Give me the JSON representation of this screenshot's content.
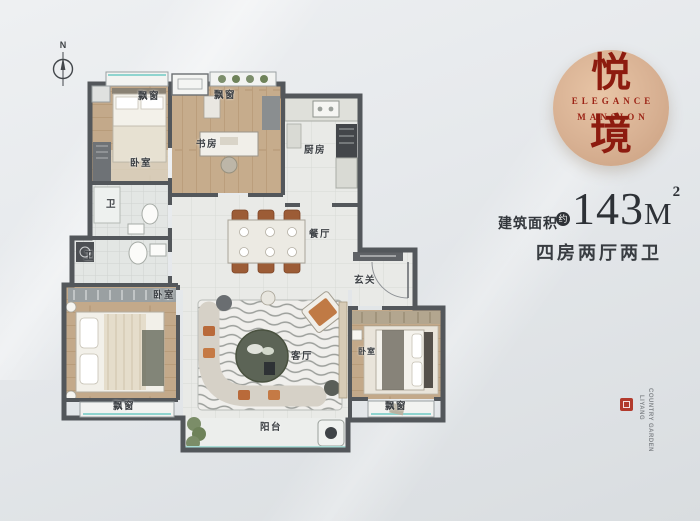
{
  "compass": {
    "label": "N"
  },
  "logo": {
    "char_top": "悦",
    "english_line1": "ELEGANCE",
    "english_line2": "MANSION",
    "char_bottom": "境"
  },
  "area": {
    "label": "建筑面积",
    "approx_badge": "约",
    "value": "143",
    "unit": "M",
    "superscript": "2"
  },
  "layout_summary": "四房两厅两卫",
  "floorplan": {
    "rooms": {
      "bedroom_top_left": "卧室",
      "study": "书房",
      "kitchen": "厨房",
      "bath_upper": "卫",
      "bath_lower": "卫",
      "dining": "餐厅",
      "entry": "玄关",
      "bedroom_bottom_left": "卧室",
      "living": "客厅",
      "bedroom_bottom_right": "卧室",
      "balcony": "阳台",
      "bay_window_top_left": "飘窗",
      "bay_window_study": "飘窗",
      "bay_window_bottom_left": "飘窗",
      "bay_window_bottom_right": "飘窗"
    }
  },
  "watermark": {
    "line_left": "LIYANG",
    "line_right": "COUNTRY GARDEN"
  },
  "colors": {
    "accent_red": "#9c2315",
    "logo_circle": "#d8b193",
    "wall": "#53575b",
    "text_dark": "#33373c"
  }
}
